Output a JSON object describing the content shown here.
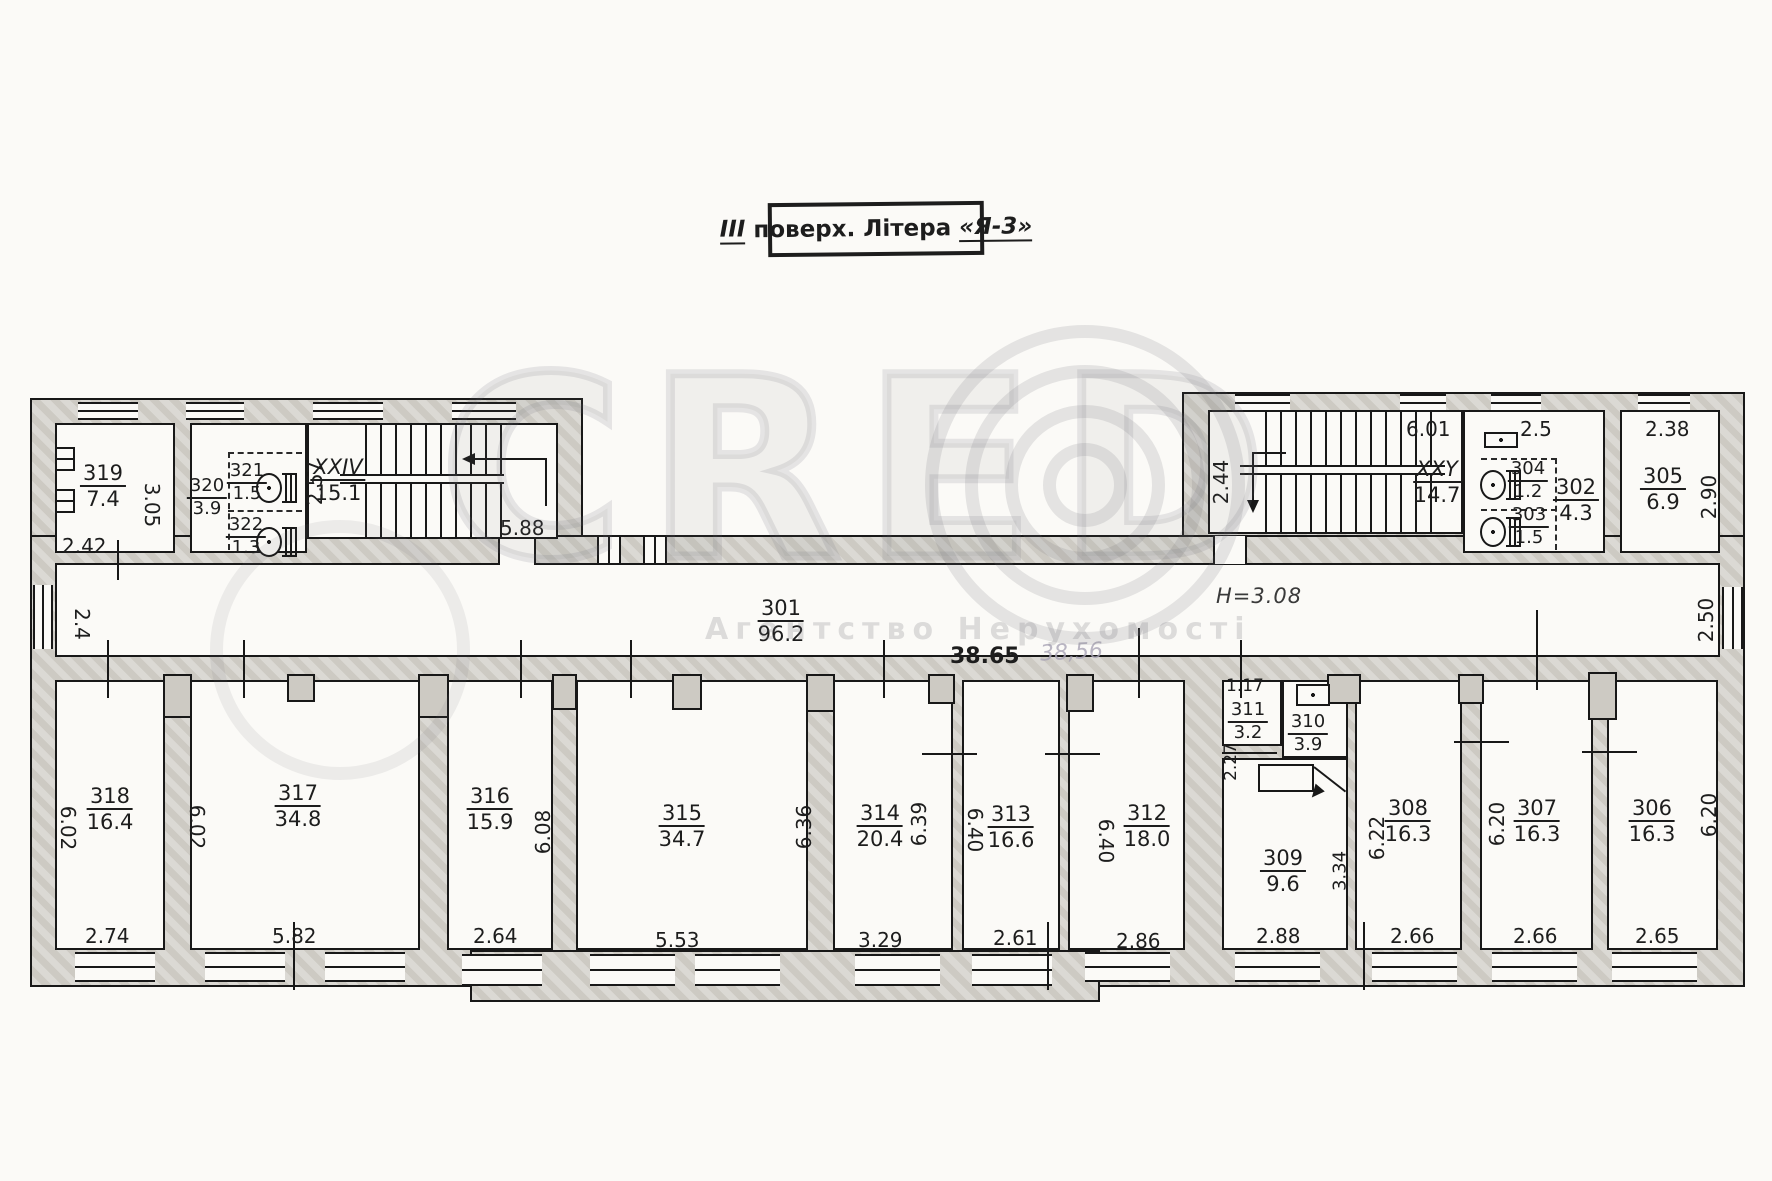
{
  "title_block": {
    "floor": "ІІІ",
    "floor_word": "поверх.",
    "litera_word": "Літера",
    "litera_value": "«Я-3»"
  },
  "watermark": {
    "logo_text": "CRED",
    "agency": "Агентство Нерухомості"
  },
  "notes": {
    "height_note": "H=3.08",
    "length_total": "38.65",
    "length_pencil": "38,56"
  },
  "corridor": {
    "number": "301",
    "area": "96.2",
    "dim_west": "2.4",
    "dim_east": "2.50"
  },
  "stairs": {
    "left": {
      "number": "XXIV",
      "area": "15.1",
      "dim_width": "2.57",
      "dim_depth": "5.88"
    },
    "right": {
      "number": "XXY",
      "area": "14.7",
      "dim_top": "6.01",
      "dim_landing": "2.44"
    }
  },
  "rooms": {
    "r302": {
      "number": "302",
      "area": "4.3",
      "dim_top": "2.5"
    },
    "r303": {
      "number": "303",
      "area": "1.5"
    },
    "r304": {
      "number": "304",
      "area": "1.2"
    },
    "r305": {
      "number": "305",
      "area": "6.9",
      "dim_top": "2.38",
      "dim_side": "2.90"
    },
    "r306": {
      "number": "306",
      "area": "16.3",
      "dim_w": "2.65",
      "dim_h": "6.20"
    },
    "r307": {
      "number": "307",
      "area": "16.3",
      "dim_w": "2.66",
      "dim_h": "6.20"
    },
    "r308": {
      "number": "308",
      "area": "16.3",
      "dim_w": "2.66",
      "dim_h": "6.22"
    },
    "r309": {
      "number": "309",
      "area": "9.6",
      "dim_w": "2.88",
      "dim_side": "3.34"
    },
    "r310": {
      "number": "310",
      "area": "3.9"
    },
    "r311": {
      "number": "311",
      "area": "3.2",
      "dim_top": "1.17",
      "dim_side": "2.27"
    },
    "r312": {
      "number": "312",
      "area": "18.0",
      "dim_w": "2.86",
      "dim_h": "6.40"
    },
    "r313": {
      "number": "313",
      "area": "16.6",
      "dim_w": "2.61",
      "dim_h": "6.40"
    },
    "r314": {
      "number": "314",
      "area": "20.4",
      "dim_w": "3.29",
      "dim_h_left": "6.36",
      "dim_h_right": "6.39"
    },
    "r315": {
      "number": "315",
      "area": "34.7",
      "dim_w": "5.53",
      "dim_h": "6.08"
    },
    "r316": {
      "number": "316",
      "area": "15.9",
      "dim_w": "2.64"
    },
    "r317": {
      "number": "317",
      "area": "34.8",
      "dim_w": "5.82",
      "dim_h": "6.02"
    },
    "r318": {
      "number": "318",
      "area": "16.4",
      "dim_w": "2.74",
      "dim_h": "6.02"
    },
    "r319": {
      "number": "319",
      "area": "7.4",
      "dim_w": "2.42",
      "dim_h": "3.05"
    },
    "r320": {
      "number": "320",
      "area": "3.9"
    },
    "r321": {
      "number": "321",
      "area": "1.5"
    },
    "r322": {
      "number": "322",
      "area": "1.3"
    }
  }
}
